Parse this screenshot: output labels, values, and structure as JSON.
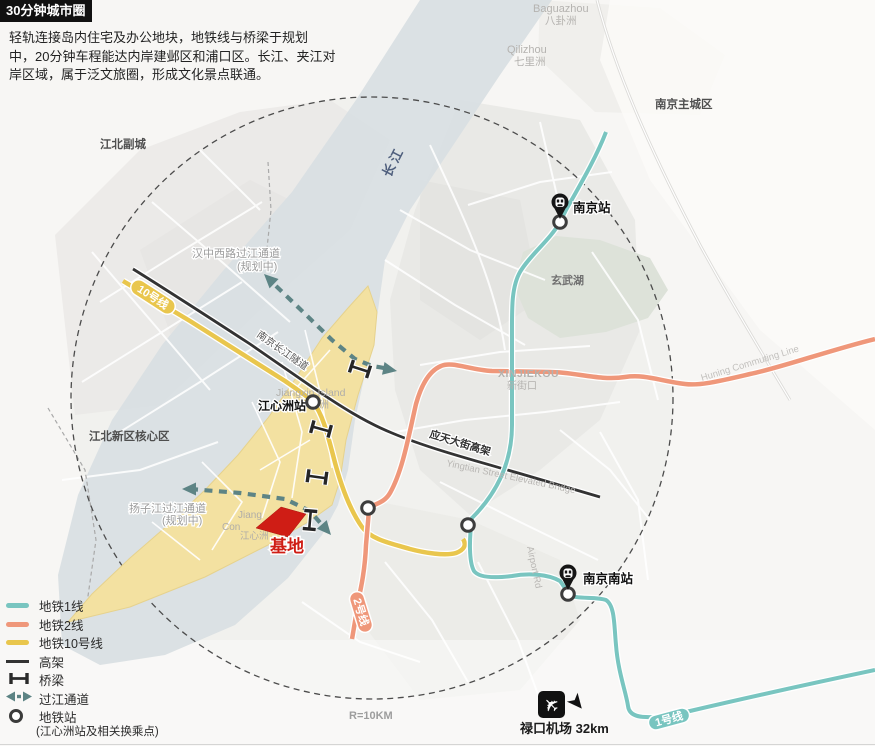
{
  "header": {
    "title": "30分钟城市圈",
    "description_lines": [
      "轻轨连接岛内住宅及办公地块，地铁线与桥梁于规划",
      "中，20分钟车程能达内岸建邺区和浦口区。长江、夹江对",
      "岸区域，属于泛文旅圈，形成文化景点联通。"
    ]
  },
  "legend": {
    "items": [
      {
        "label": "地铁1线",
        "color": "#79c5c0"
      },
      {
        "label": "地铁2线",
        "color": "#ef977a"
      },
      {
        "label": "地铁10号线",
        "color": "#e9c64d"
      },
      {
        "label": "高架",
        "color": "#333333"
      },
      {
        "label": "桥梁",
        "color": "#2a2a2a"
      },
      {
        "label": "过江通道",
        "color": "#5c8384"
      },
      {
        "label": "地铁站",
        "color": "#3b3b3b"
      }
    ],
    "note": "(江心洲站及相关换乘点)"
  },
  "map": {
    "region_labels": {
      "yangtze_river": "长江",
      "jiangbei_subcity": "江北副城",
      "jiangbei_core": "江北新区核心区",
      "nanjing_main_city": "南京主城区",
      "baguazhou_en": "Baguazhou",
      "baguazhou_cn": "八卦洲",
      "qilizhou_en": "Qilizhou",
      "qilizhou_cn": "七里洲",
      "xuanwu_lake": "玄武湖",
      "xinjiekou_en": "XINJIEKOU",
      "xinjiekou_cn": "新街口"
    },
    "road_labels": {
      "tunnel": "南京长江隧道",
      "yingtian_cn": "应天大街高架",
      "yingtian_en": "Yingtian Street Elevated Bridge",
      "airport_rd": "Airport Rd",
      "huning_line": "Huning Commuting Line"
    },
    "crossing_labels": {
      "hanzhong": "汉中西路过江通道",
      "hanzhong_planned": "(规划中)",
      "yangzijiang": "扬子江过江通道",
      "yangzijiang_planned": "(规划中)"
    },
    "stations": {
      "nanjing": "南京站",
      "nanjing_south": "南京南站",
      "jiangxinzhou": "江心洲站",
      "jiangxin_island_en": "Jiangxin Island",
      "island_fragment_1": "Jiang",
      "island_fragment_2": "Con",
      "island_gray_cn": "江心洲",
      "zhou_fragment": "洲"
    },
    "badges": {
      "line10": "10号线",
      "line2": "2号线",
      "line1": "1号线"
    },
    "site_label": "基地",
    "radius_label": "R=10KM",
    "airport_label": "禄口机场 32km",
    "colors": {
      "line1": "#79c5c0",
      "line2": "#ef977a",
      "line10": "#e9c64d",
      "elevated": "#333333",
      "crossing": "#5d8485",
      "site": "#cf1d15",
      "river": "#d9dfe3",
      "island": "#f3e1a1"
    }
  }
}
